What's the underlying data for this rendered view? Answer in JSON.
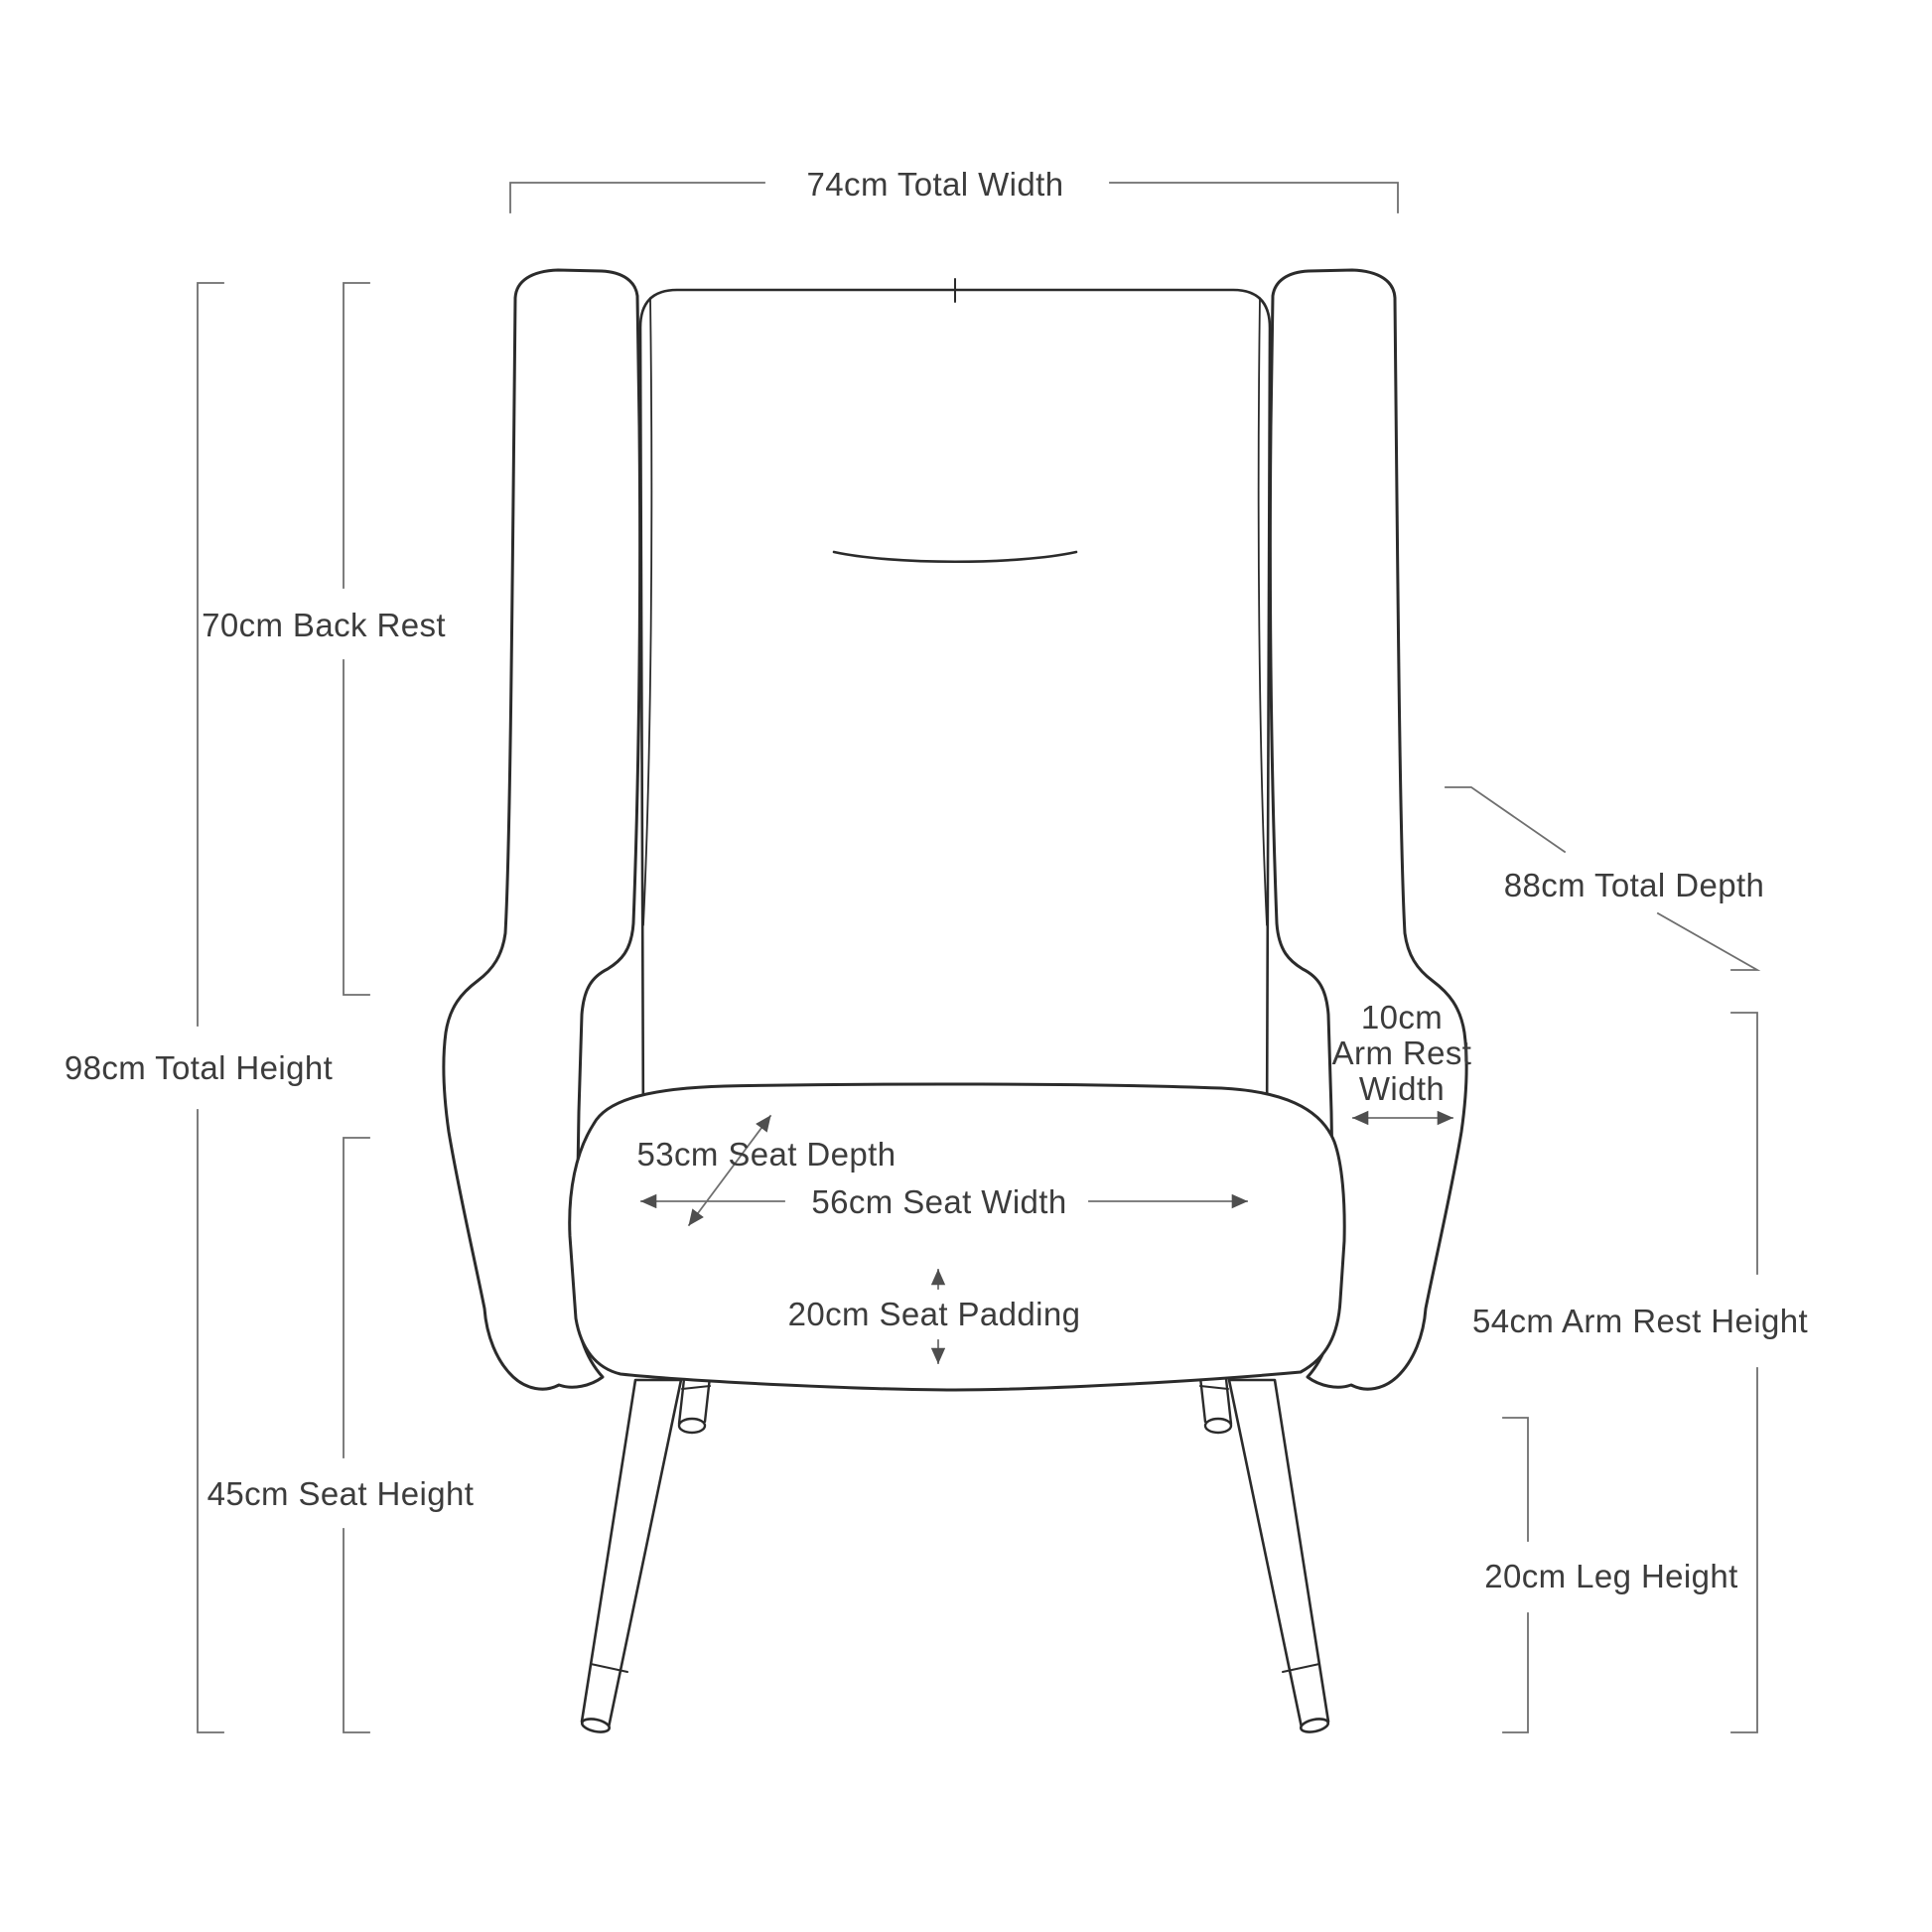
{
  "diagram": {
    "subject": "armchair front-view dimension drawing",
    "colors": {
      "background": "#ffffff",
      "chair_line": "#2b2b2b",
      "dimension_line": "#6f6f6f",
      "text": "#3c3c3c"
    },
    "labels": {
      "total_width": "74cm Total Width",
      "back_rest": "70cm Back Rest",
      "total_height": "98cm Total Height",
      "seat_height": "45cm Seat Height",
      "total_depth": "88cm Total Depth",
      "arm_rest_width": {
        "lines": [
          "10cm",
          "Arm Rest",
          "Width"
        ]
      },
      "seat_depth": "53cm Seat Depth",
      "seat_width": "56cm Seat Width",
      "seat_padding": "20cm Seat Padding",
      "arm_rest_height": "54cm Arm Rest Height",
      "leg_height": "20cm Leg Height"
    },
    "measurements": [
      {
        "dimension": "Total Width",
        "value": "74cm"
      },
      {
        "dimension": "Back Rest",
        "value": "70cm"
      },
      {
        "dimension": "Total Height",
        "value": "98cm"
      },
      {
        "dimension": "Seat Height",
        "value": "45cm"
      },
      {
        "dimension": "Total Depth",
        "value": "88cm"
      },
      {
        "dimension": "Arm Rest Width",
        "value": "10cm"
      },
      {
        "dimension": "Seat Depth",
        "value": "53cm"
      },
      {
        "dimension": "Seat Width",
        "value": "56cm"
      },
      {
        "dimension": "Seat Padding",
        "value": "20cm"
      },
      {
        "dimension": "Arm Rest Height",
        "value": "54cm"
      },
      {
        "dimension": "Leg Height",
        "value": "20cm"
      }
    ]
  }
}
